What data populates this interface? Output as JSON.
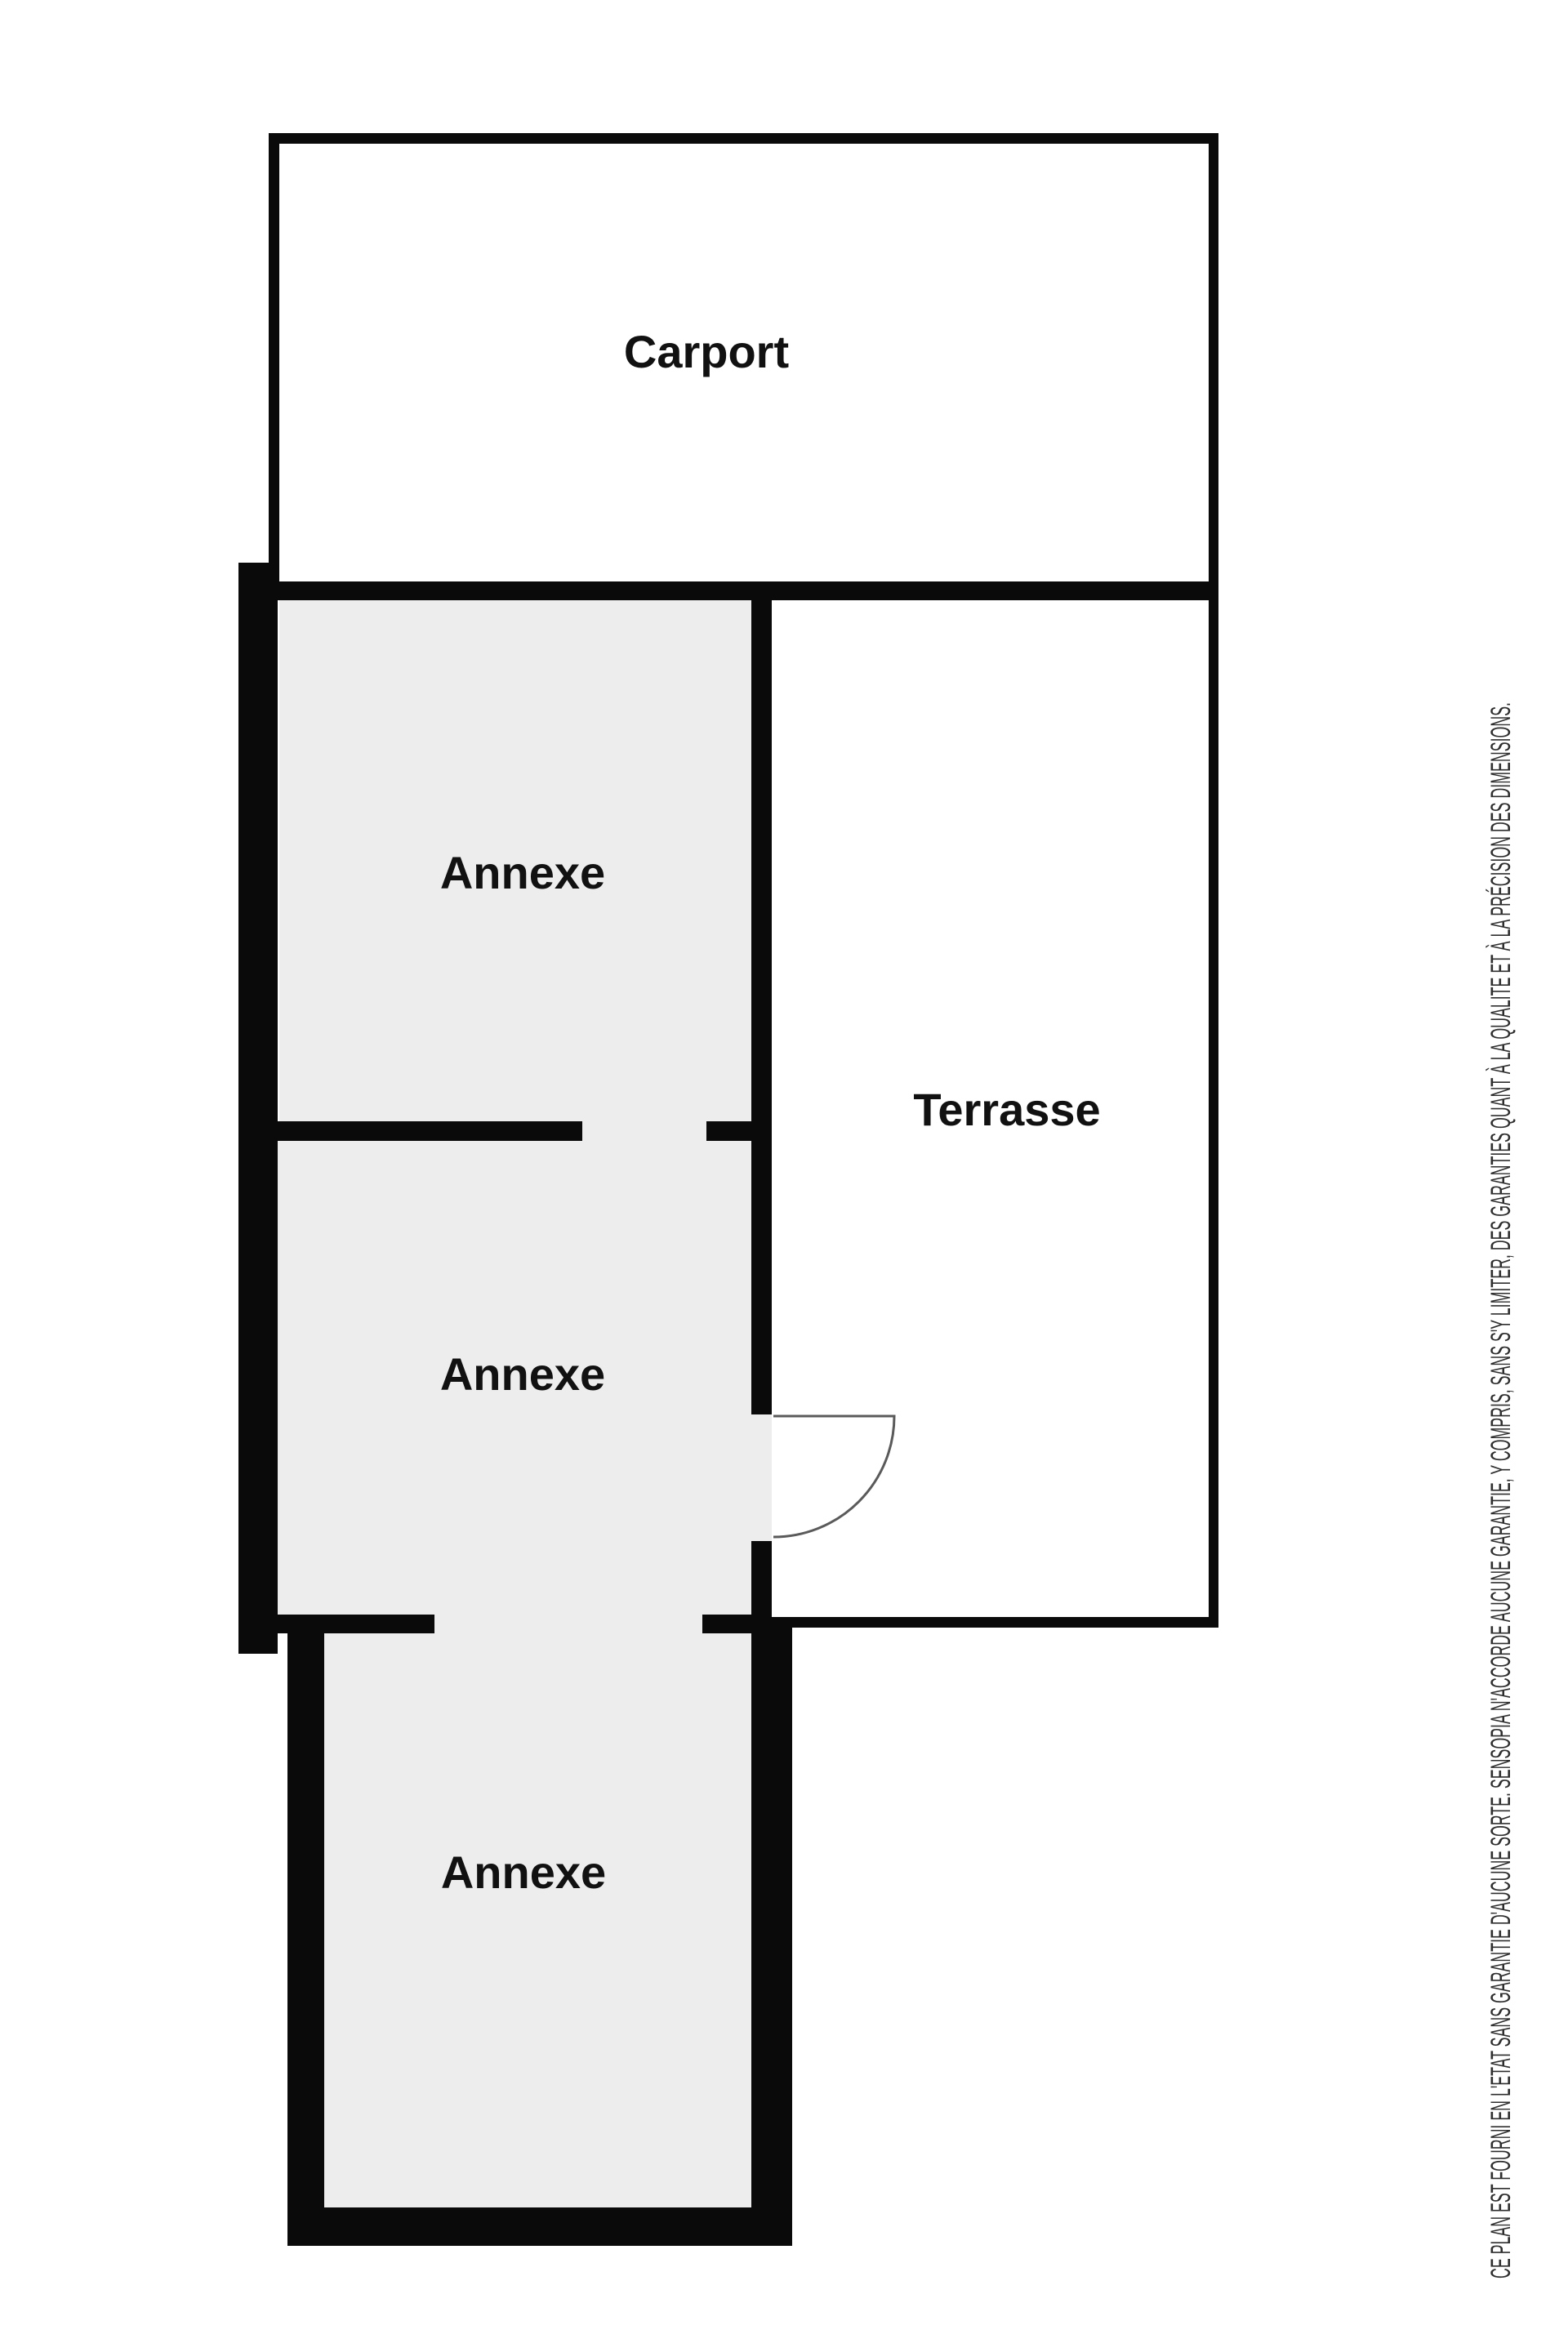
{
  "floorplan": {
    "rooms": [
      {
        "name": "carport",
        "label": "Carport"
      },
      {
        "name": "annexe-upper",
        "label": "Annexe"
      },
      {
        "name": "terrasse",
        "label": "Terrasse"
      },
      {
        "name": "annexe-middle",
        "label": "Annexe"
      },
      {
        "name": "annexe-lower",
        "label": "Annexe"
      }
    ],
    "colors": {
      "wall": "#0a0a0a",
      "room_fill_gray": "#ededed",
      "room_fill_white": "#ffffff",
      "door_stroke": "#5a5a5a",
      "label_text": "#111111",
      "disclaimer_text": "#2e2e2e"
    }
  },
  "disclaimer": {
    "text": "CE PLAN EST FOURNI EN L'ETAT SANS GARANTIE D'AUCUNE SORTE. SENSOPIA N'ACCORDE AUCUNE GARANTIE, Y COMPRIS, SANS S'Y LIMITER, DES GARANTIES QUANT À LA QUALITE ET À LA PRÉCISION DES DIMENSIONS."
  }
}
